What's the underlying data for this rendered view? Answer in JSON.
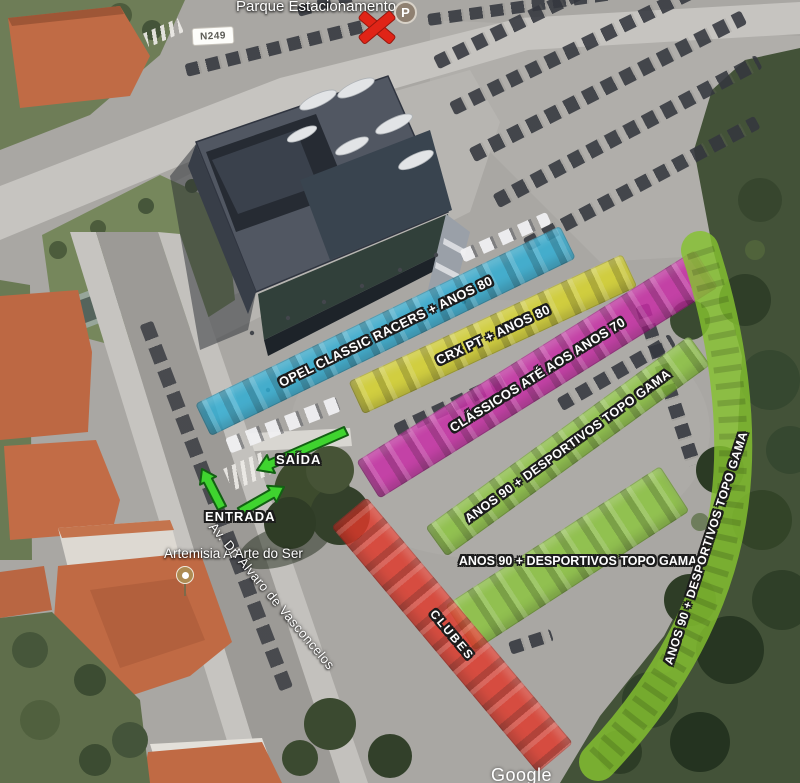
{
  "map_labels": {
    "area_title": "Parque Estacionamento",
    "road_badge": "N249",
    "parking_marker_letter": "P",
    "poi_name": "Artemisia A Arte do Ser",
    "street_name": "Av. Dr. Álvaro de Vasconcelos",
    "watermark": "Google"
  },
  "navigation": {
    "entrance_label": "ENTRADA",
    "exit_label": "SAÍDA"
  },
  "zones": [
    {
      "id": "opel-classic-racers",
      "label": "OPEL CLASSIC RACERS + ANOS 80",
      "color": "#2FAFD6"
    },
    {
      "id": "crx-pt",
      "label": "CRX PT + ANOS 80",
      "color": "#D9D62A"
    },
    {
      "id": "classicos-anos-70",
      "label": "CLÁSSICOS ATÉ AOS ANOS 70",
      "color": "#C92BA6"
    },
    {
      "id": "anos90-topo-gama-row",
      "label": "ANOS 90 + DESPORTIVOS TOPO GAMA",
      "color": "#8CC63E"
    },
    {
      "id": "anos90-topo-gama-block",
      "label": "ANOS 90 + DESPORTIVOS TOPO GAMA",
      "color": "#8CC63E"
    },
    {
      "id": "anos90-topo-gama-curve",
      "label": "ANOS 90 + DESPORTIVOS TOPO GAMA",
      "color": "#85C230"
    },
    {
      "id": "clubes",
      "label": "CLUBES",
      "color": "#E0392B"
    }
  ],
  "colors": {
    "arrow_fill": "#3FD42F",
    "arrow_outline": "#136013"
  }
}
